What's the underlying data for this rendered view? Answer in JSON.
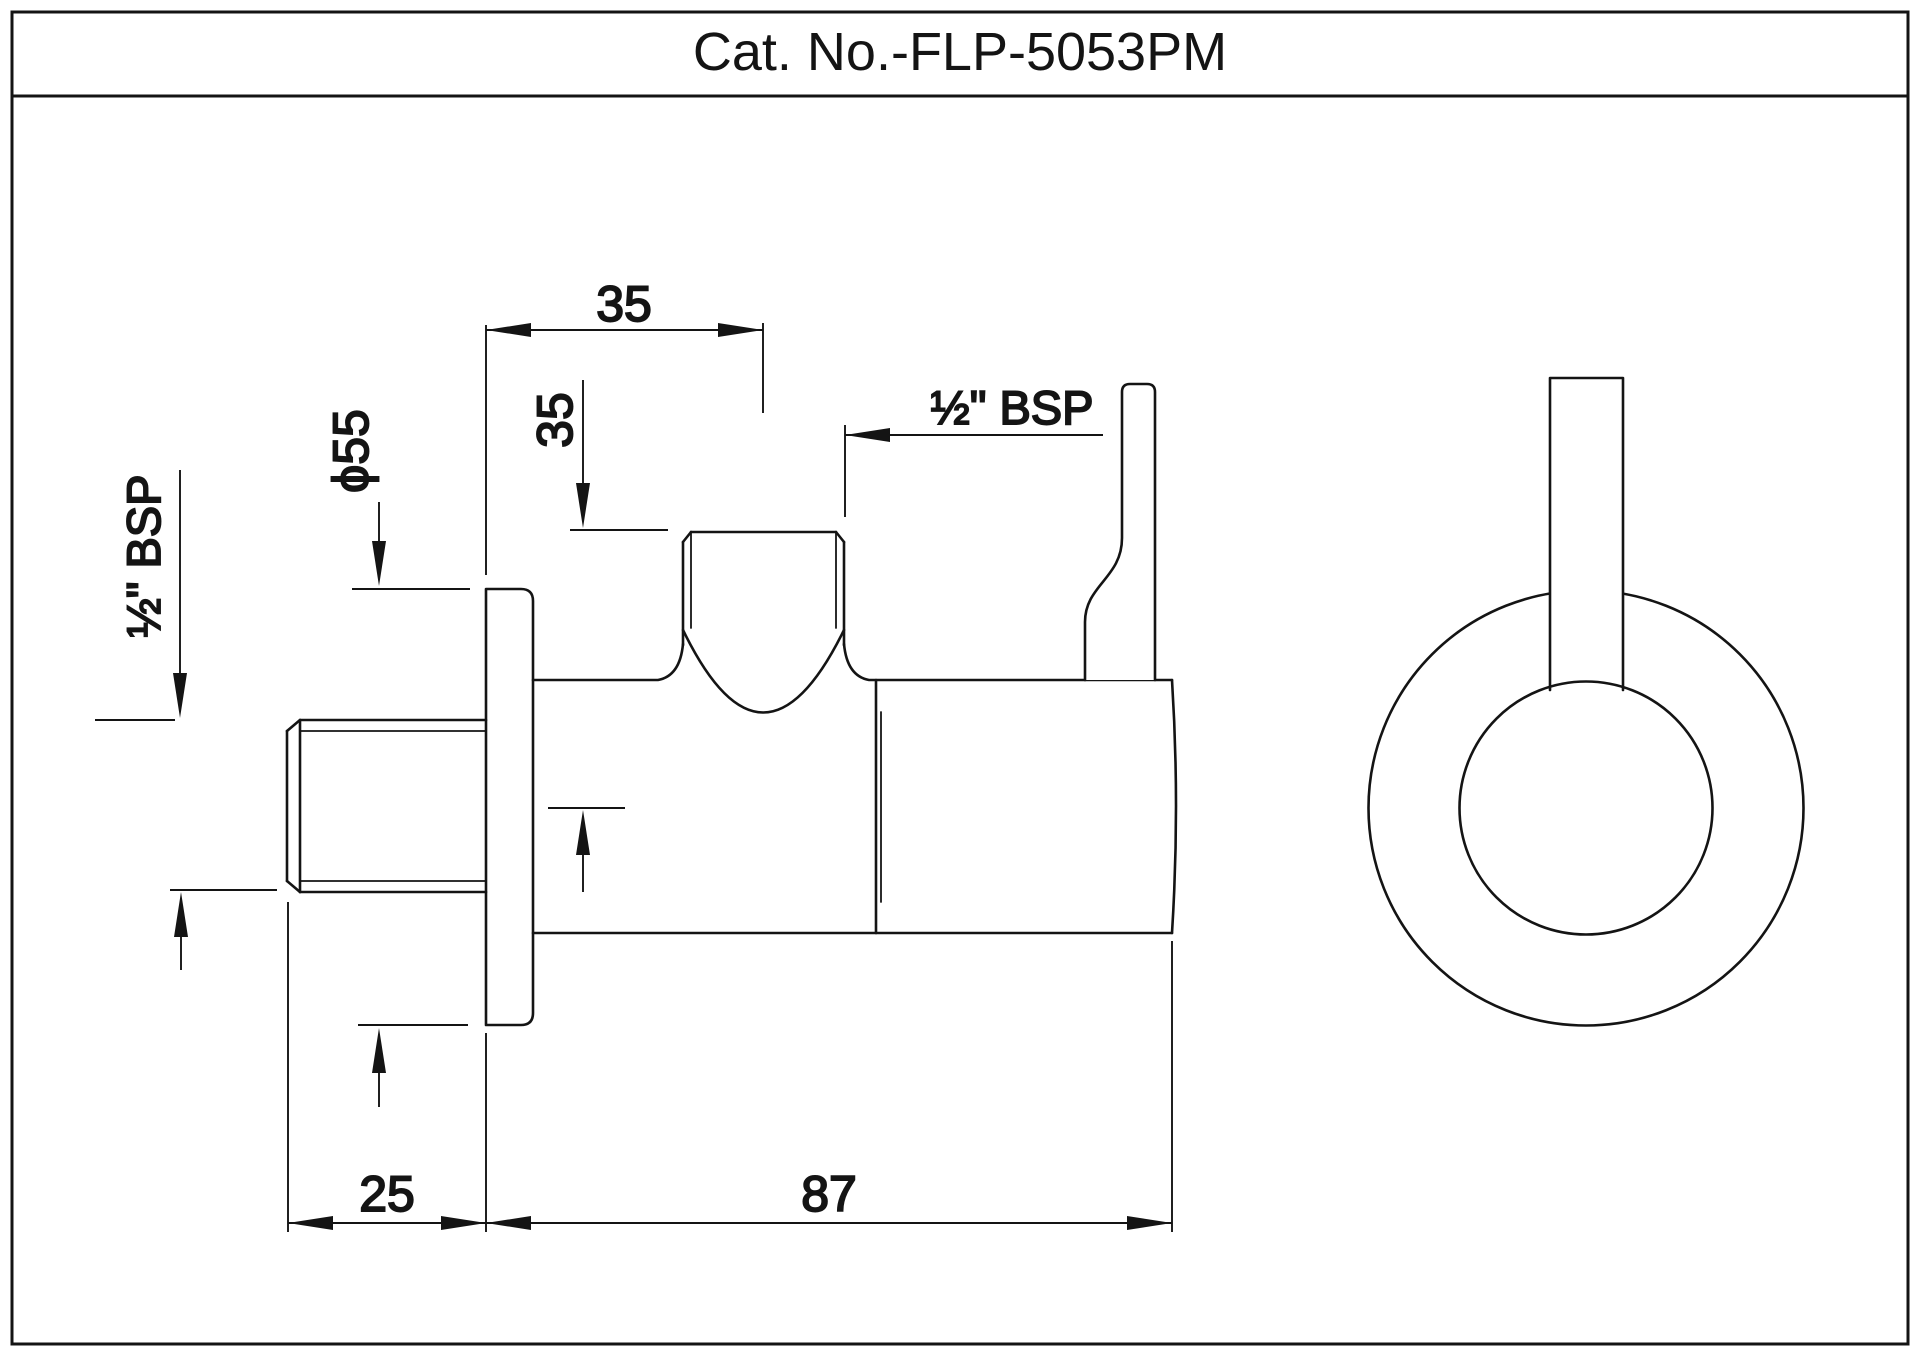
{
  "title": "Cat. No.-FLP-5053PM",
  "dimensions": {
    "top_offset": "35",
    "outlet_height": "35",
    "outlet_thread": "½\" BSP",
    "inlet_thread": "½\" BSP",
    "flange_diameter": "ϕ55",
    "inlet_length": "25",
    "body_length": "87"
  },
  "colors": {
    "line": "#141414",
    "background": "#ffffff"
  }
}
